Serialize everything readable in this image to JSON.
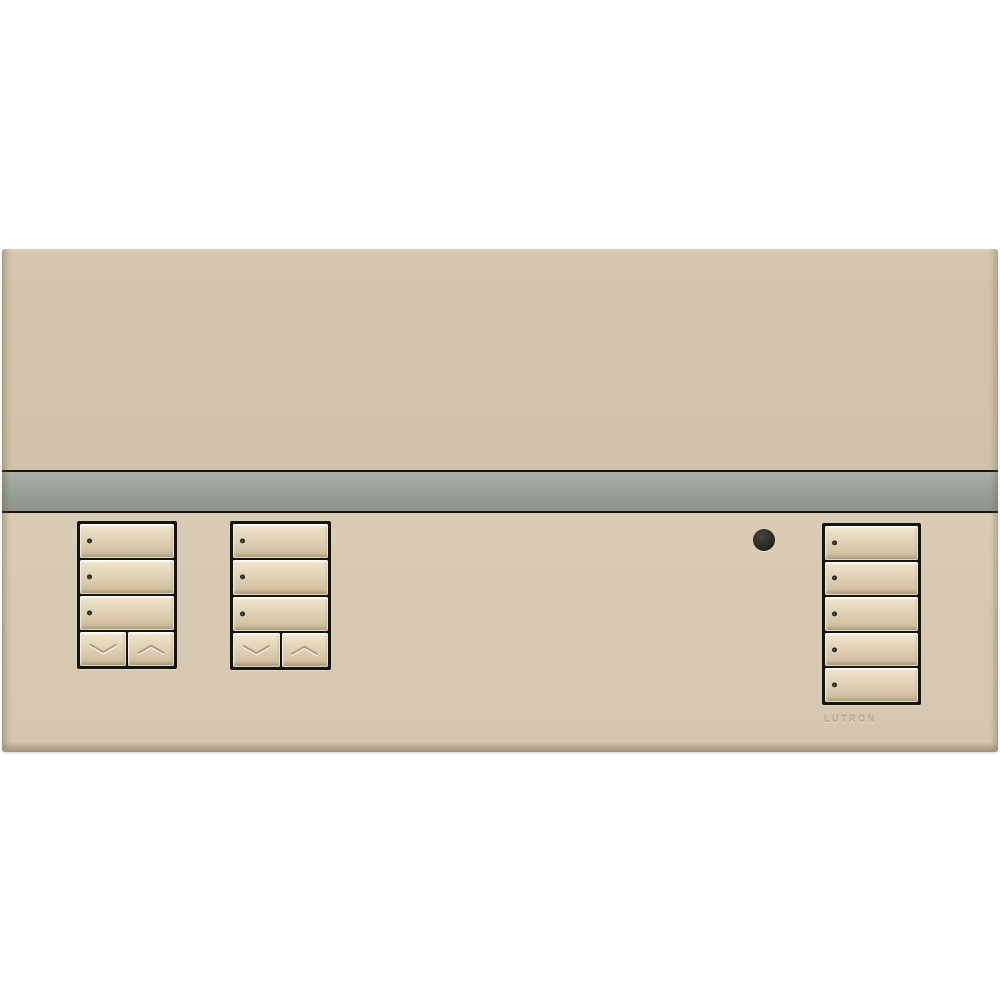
{
  "device": {
    "name": "wall-mounted lighting control keypad panel",
    "brand_label": "LUTRON"
  },
  "colors": {
    "page_bg": "#ffffff",
    "panel_upper": "#d3c4ac",
    "panel_lower": "#d8cab2",
    "panel_bevel_bottom": "#a2947b",
    "stripe_top": "#abb1a9",
    "stripe_mid": "#99a097",
    "stripe_bottom": "#8d948d",
    "frame_black": "#17140e",
    "button_light": "#f0e6cf",
    "button_dark": "#c9b697",
    "chevron_shadow": "#ab9a7e",
    "led_dark": "#2e2b24",
    "ir_dark": "#23221e",
    "brand_text": "#c0b094"
  },
  "keypads": [
    {
      "id": "left",
      "name": "keypad-left",
      "buttons": [
        {
          "name": "scene-button-1",
          "size": "full",
          "led": true
        },
        {
          "name": "scene-button-2",
          "size": "full",
          "led": true
        },
        {
          "name": "scene-button-3",
          "size": "full",
          "led": true
        },
        {
          "name": "lower-button",
          "size": "half",
          "icon": "chevron-down"
        },
        {
          "name": "raise-button",
          "size": "half",
          "icon": "chevron-up"
        }
      ]
    },
    {
      "id": "middle",
      "name": "keypad-middle",
      "buttons": [
        {
          "name": "scene-button-1",
          "size": "full",
          "led": true
        },
        {
          "name": "scene-button-2",
          "size": "full",
          "led": true
        },
        {
          "name": "scene-button-3",
          "size": "full",
          "led": true
        },
        {
          "name": "lower-button",
          "size": "half",
          "icon": "chevron-down"
        },
        {
          "name": "raise-button",
          "size": "half",
          "icon": "chevron-up"
        }
      ]
    },
    {
      "id": "right",
      "name": "keypad-right",
      "buttons": [
        {
          "name": "scene-button-1",
          "size": "full",
          "led": true
        },
        {
          "name": "scene-button-2",
          "size": "full",
          "led": true
        },
        {
          "name": "scene-button-3",
          "size": "full",
          "led": true
        },
        {
          "name": "scene-button-4",
          "size": "full",
          "led": true
        },
        {
          "name": "scene-button-5",
          "size": "full",
          "led": true
        }
      ]
    }
  ],
  "indicators": {
    "ir_receiver": "ir-receiver-dot"
  }
}
